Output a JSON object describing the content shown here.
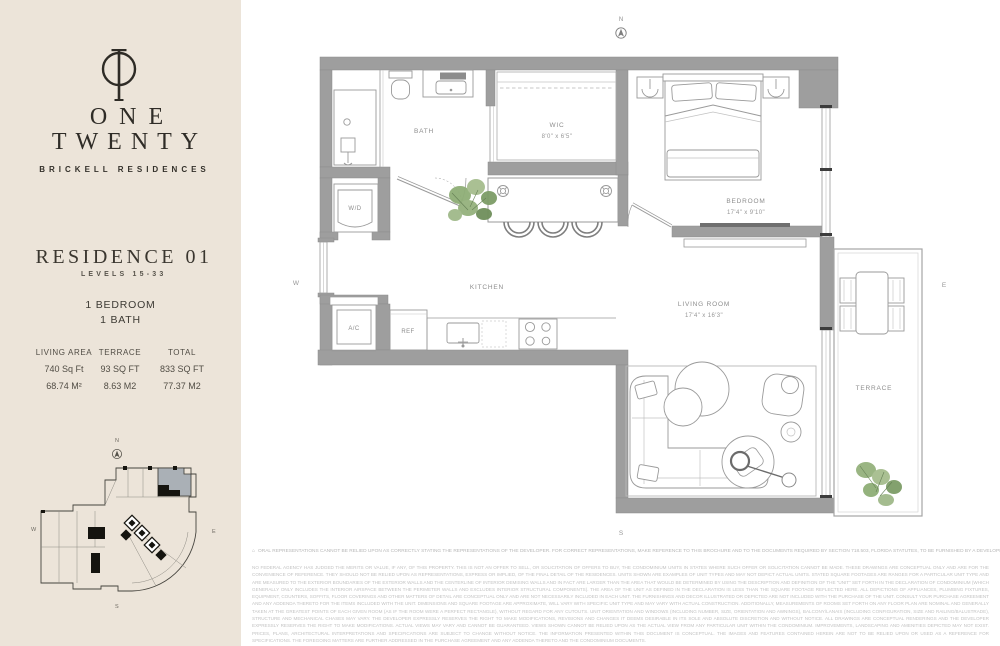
{
  "brand": {
    "name_line1": "ONE",
    "name_line2": "TWENTY",
    "tagline": "BRICKELL RESIDENCES"
  },
  "residence": {
    "title": "RESIDENCE 01",
    "levels": "LEVELS 15-33",
    "bedrooms": "1 BEDROOM",
    "baths": "1 BATH"
  },
  "stats": {
    "columns": [
      {
        "label": "LIVING AREA",
        "imperial": "740 Sq Ft",
        "metric": "68.74 M²"
      },
      {
        "label": "TERRACE",
        "imperial": "93 SQ FT",
        "metric": "8.63 M2"
      },
      {
        "label": "TOTAL",
        "imperial": "833 SQ FT",
        "metric": "77.37 M2"
      }
    ]
  },
  "compass": {
    "n": "N",
    "w": "W",
    "e": "E",
    "s": "S"
  },
  "floorplan": {
    "rooms": {
      "bath": {
        "label": "BATH"
      },
      "wic": {
        "label": "WIC",
        "dims": "8'0\" x 6'5\""
      },
      "bedroom": {
        "label": "BEDROOM",
        "dims": "17'4\" x 9'10\""
      },
      "kitchen": {
        "label": "KITCHEN"
      },
      "living_room": {
        "label": "LIVING ROOM",
        "dims": "17'4\" x 16'3\""
      },
      "terrace": {
        "label": "TERRACE"
      },
      "washer_dryer": {
        "label": "W/D"
      },
      "ac_closet": {
        "label": "A/C"
      },
      "refrigerator": {
        "label": "REF"
      }
    }
  },
  "icons": {
    "equal_housing": "⌂",
    "north_arrow": "circle-with-arrowhead",
    "logo_mark": "circle-T-monogram"
  },
  "colors": {
    "sidebar_bg": "#ece4d9",
    "ink": "#2f2c27",
    "wall_gray": "#9e9e9e",
    "line_gray": "#9a9a9a",
    "label_gray": "#8d8d8d",
    "plant_green": "#8fae77",
    "keyplan_unit_gray": "#aab0b6",
    "disclaimer_gray": "#c3c3c3"
  },
  "disclaimer": {
    "line1": "ORAL REPRESENTATIONS CANNOT BE RELIED UPON AS CORRECTLY STATING THE REPRESENTATIONS OF THE DEVELOPER. FOR CORRECT REPRESENTATIONS, MAKE REFERENCE TO THIS BROCHURE AND TO THE DOCUMENTS REQUIRED BY SECTION 718.503, FLORIDA STATUTES, TO BE FURNISHED BY A DEVELOPER TO A BUYER OR LESSEE.",
    "body": "NO FEDERAL AGENCY HAS JUDGED THE MERITS OR VALUE, IF ANY, OF THIS PROPERTY. THIS IS NOT AN OFFER TO SELL, OR SOLICITATION OF OFFERS TO BUY, THE CONDOMINIUM UNITS IN STATES WHERE SUCH OFFER OR SOLICITATION CANNOT BE MADE. THESE DRAWINGS ARE CONCEPTUAL ONLY AND ARE FOR THE CONVENIENCE OF REFERENCE. THEY SHOULD NOT BE RELIED UPON AS REPRESENTATIONS, EXPRESS OR IMPLIED, OF THE FINAL DETAIL OF THE RESIDENCES. UNITS SHOWN ARE EXAMPLES OF UNIT TYPES AND MAY NOT DEPICT ACTUAL UNITS. STATED SQUARE FOOTAGES ARE RANGES FOR A PARTICULAR UNIT TYPE AND ARE MEASURED TO THE EXTERIOR BOUNDARIES OF THE EXTERIOR WALLS AND THE CENTERLINE OF INTERIOR DEMISING WALLS AND IN FACT ARE LARGER THAN THE AREA THAT WOULD BE DETERMINED BY USING THE DESCRIPTION AND DEFINITION OF THE \"UNIT\" SET FORTH IN THE DECLARATION OF CONDOMINIUM (WHICH GENERALLY ONLY INCLUDES THE INTERIOR AIRSPACE BETWEEN THE PERIMETER WALLS AND EXCLUDES INTERIOR STRUCTURAL COMPONENTS). THE AREA OF THE UNIT AS DEFINED IN THE DECLARATION IS LESS THAN THE SQUARE FOOTAGE REFLECTED HERE. ALL DEPICTIONS OF APPLIANCES, PLUMBING FIXTURES, EQUIPMENT, COUNTERS, SOFFITS, FLOOR COVERINGS AND OTHER MATTERS OF DETAIL ARE CONCEPTUAL ONLY AND ARE NOT NECESSARILY INCLUDED IN EACH UNIT. THE FURNISHINGS AND DECOR ILLUSTRATED OR DEPICTED ARE NOT INCLUDED WITH THE PURCHASE OF THE UNIT. CONSULT YOUR PURCHASE AGREEMENT AND ANY ADDENDA THERETO FOR THE ITEMS INCLUDED WITH THE UNIT. DIMENSIONS AND SQUARE FOOTAGE ARE APPROXIMATE, WILL VARY WITH SPECIFIC UNIT TYPE AND MAY VARY WITH ACTUAL CONSTRUCTION. ADDITIONALLY, MEASUREMENTS OF ROOMS SET FORTH ON ANY FLOOR PLAN ARE NOMINAL AND GENERALLY TAKEN AT THE GREATEST POINTS OF EACH GIVEN ROOM (AS IF THE ROOM WERE A PERFECT RECTANGLE), WITHOUT REGARD FOR ANY CUTOUTS. UNIT ORIENTATION AND WINDOWS (INCLUDING NUMBER, SIZE, ORIENTATION AND AWNINGS), BALCONY/LANAIS (INCLUDING CONFIGURATION, SIZE AND RAILING/BALUSTRADE), STRUCTURE AND MECHANICAL CHASES MAY VARY. THE DEVELOPER EXPRESSLY RESERVES THE RIGHT TO MAKE MODIFICATIONS, REVISIONS AND CHANGES IT DEEMS DESIRABLE IN ITS SOLE AND ABSOLUTE DISCRETION AND WITHOUT NOTICE. ALL DRAWINGS ARE CONCEPTUAL RENDERINGS AND THE DEVELOPER EXPRESSLY RESERVES THE RIGHT TO MAKE MODIFICATIONS. ACTUAL VIEWS MAY VARY AND CANNOT BE GUARANTEED. VIEWS SHOWN CANNOT BE RELIED UPON AS THE ACTUAL VIEW FROM ANY PARTICULAR UNIT WITHIN THE CONDOMINIUM. IMPROVEMENTS, LANDSCAPING AND AMENITIES DEPICTED MAY NOT EXIST. PRICES, PLANS, ARCHITECTURAL INTERPRETATIONS AND SPECIFICATIONS ARE SUBJECT TO CHANGE WITHOUT NOTICE. THE INFORMATION PRESENTED WITHIN THIS DOCUMENT IS CONCEPTUAL. THE IMAGES AND FEATURES CONTAINED HEREIN ARE NOT TO BE RELIED UPON OR USED AS A REFERENCE FOR SPECIFICATIONS. THE FOREGOING MATTERS ARE FURTHER ADDRESSED IN THE PURCHASE AGREEMENT AND ANY ADDENDA THERETO AND THE CONDOMINIUM DOCUMENTS."
  }
}
